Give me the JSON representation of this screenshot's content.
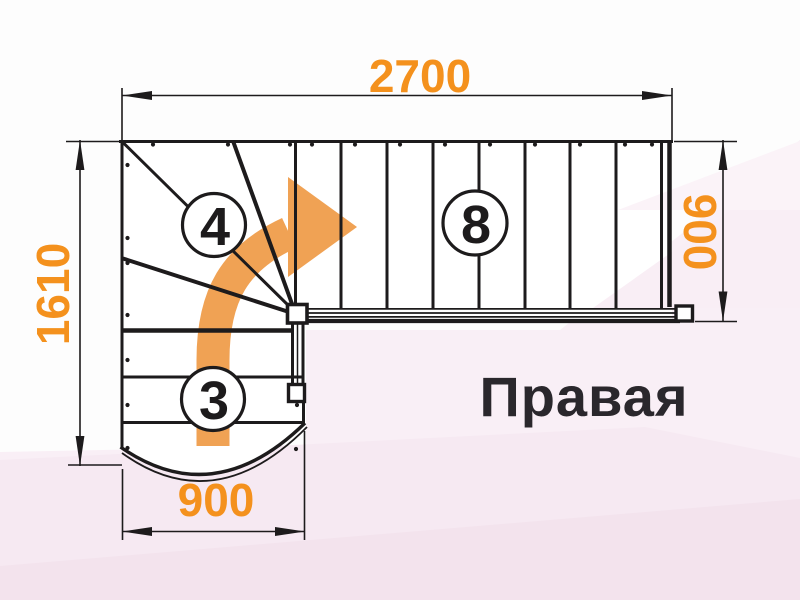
{
  "title": {
    "text": "Правая"
  },
  "dimensions": {
    "top": "2700",
    "left": "1610",
    "right": "900",
    "bottom": "900"
  },
  "step_labels": {
    "winder_steps": "4",
    "upper_flight_steps": "8",
    "lower_flight_steps": "3"
  },
  "colors": {
    "dimension_text": "#F4911D",
    "direction_arrow": "#F0A254",
    "drawing_lines": "#1D1B1C",
    "title_text": "#2A272C",
    "floor_pink": "#F8ECF3"
  },
  "icons": {
    "direction_arrow": "curved-right-turn-arrow"
  }
}
